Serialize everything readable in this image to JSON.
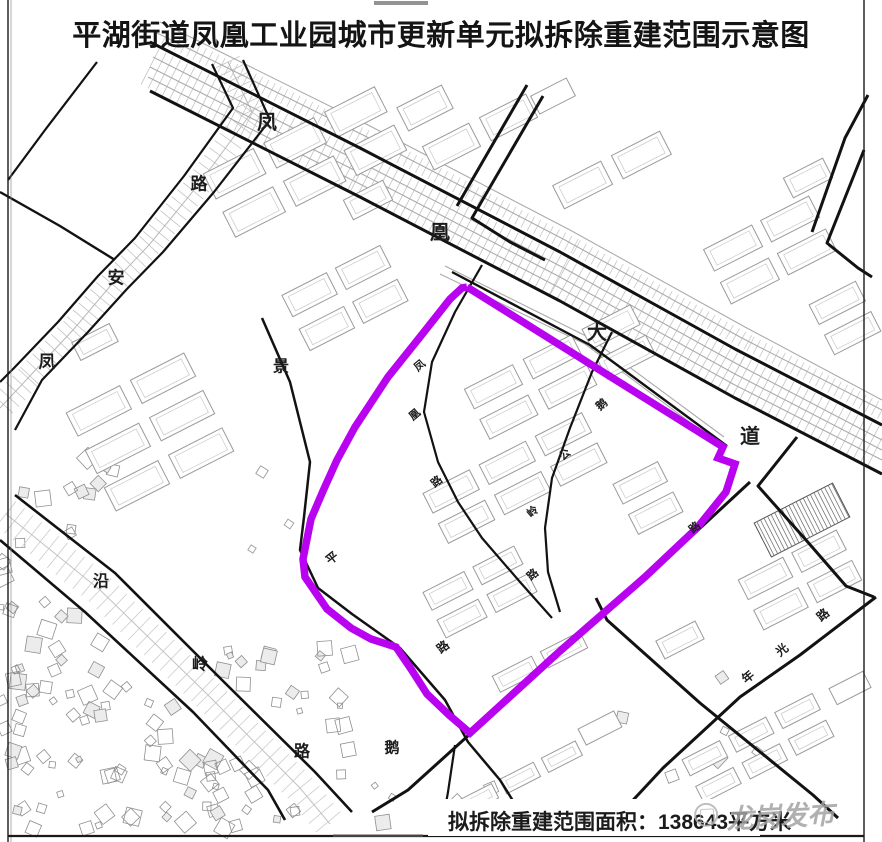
{
  "title": "平湖街道凤凰工业园城市更新单元拟拆除重建范围示意图",
  "caption": {
    "text": "拟拆除重建范围面积：138643平方米",
    "label": "拟拆除重建范围面积",
    "value": "138643",
    "unit": "平方米"
  },
  "watermark": {
    "text": "龙岗发布",
    "logo": "circle-emblem"
  },
  "map": {
    "colors": {
      "boundary": "#b802f0",
      "road": "#121212",
      "building": "#9a9a9a",
      "hatch": "#bdbdbd",
      "frame": "#1a1a1a"
    },
    "boundary": {
      "width": 7.5,
      "points": [
        [
          467,
          287
        ],
        [
          723,
          447
        ],
        [
          718,
          458
        ],
        [
          735,
          464
        ],
        [
          726,
          492
        ],
        [
          697,
          528
        ],
        [
          645,
          577
        ],
        [
          560,
          651
        ],
        [
          470,
          733
        ],
        [
          449,
          715
        ],
        [
          427,
          694
        ],
        [
          411,
          669
        ],
        [
          396,
          647
        ],
        [
          371,
          639
        ],
        [
          351,
          628
        ],
        [
          327,
          609
        ],
        [
          305,
          577
        ],
        [
          303,
          559
        ],
        [
          311,
          519
        ],
        [
          323,
          491
        ],
        [
          337,
          460
        ],
        [
          355,
          427
        ],
        [
          388,
          377
        ],
        [
          420,
          337
        ],
        [
          450,
          299
        ],
        [
          462,
          288
        ],
        [
          467,
          287
        ]
      ]
    },
    "labels": [
      {
        "t": "凤",
        "x": 267,
        "y": 123,
        "s": 20
      },
      {
        "t": "凰",
        "x": 440,
        "y": 233,
        "s": 20
      },
      {
        "t": "大",
        "x": 597,
        "y": 333,
        "s": 20
      },
      {
        "t": "道",
        "x": 750,
        "y": 437,
        "s": 20
      },
      {
        "t": "路",
        "x": 199,
        "y": 184,
        "s": 17
      },
      {
        "t": "安",
        "x": 116,
        "y": 278,
        "s": 17
      },
      {
        "t": "凤",
        "x": 47,
        "y": 362,
        "s": 17
      },
      {
        "t": "景",
        "x": 281,
        "y": 367,
        "s": 16
      },
      {
        "t": "沿",
        "x": 101,
        "y": 582,
        "s": 16
      },
      {
        "t": "岭",
        "x": 200,
        "y": 665,
        "s": 16
      },
      {
        "t": "路",
        "x": 302,
        "y": 752,
        "s": 16
      },
      {
        "t": "鹅",
        "x": 392,
        "y": 748,
        "s": 15
      },
      {
        "t": "平",
        "x": 332,
        "y": 558,
        "s": 12,
        "r": -38
      },
      {
        "t": "路",
        "x": 443,
        "y": 647,
        "s": 12,
        "r": -38
      },
      {
        "t": "凤",
        "x": 420,
        "y": 366,
        "s": 11,
        "r": -40
      },
      {
        "t": "凰",
        "x": 415,
        "y": 415,
        "s": 11,
        "r": -40
      },
      {
        "t": "路",
        "x": 437,
        "y": 482,
        "s": 11,
        "r": -40
      },
      {
        "t": "鹅",
        "x": 602,
        "y": 405,
        "s": 11,
        "r": -40
      },
      {
        "t": "公",
        "x": 565,
        "y": 455,
        "s": 11,
        "r": -40
      },
      {
        "t": "岭",
        "x": 533,
        "y": 512,
        "s": 11,
        "r": -40
      },
      {
        "t": "路",
        "x": 533,
        "y": 575,
        "s": 11,
        "r": -40
      },
      {
        "t": "路",
        "x": 695,
        "y": 528,
        "s": 11,
        "r": -40
      },
      {
        "t": "路",
        "x": 823,
        "y": 615,
        "s": 12,
        "r": -40
      },
      {
        "t": "光",
        "x": 782,
        "y": 650,
        "s": 12,
        "r": -40
      },
      {
        "t": "年",
        "x": 748,
        "y": 677,
        "s": 12,
        "r": -40
      }
    ],
    "corridors": {
      "avenue": {
        "center": [
          [
            150,
            67
          ],
          [
            360,
            173
          ],
          [
            560,
            277
          ],
          [
            735,
            374
          ],
          [
            882,
            450
          ]
        ],
        "half": 20,
        "tickStep": 8
      },
      "fengan": {
        "center": [
          [
            228,
            62
          ],
          [
            252,
            112
          ],
          [
            199,
            184
          ],
          [
            149,
            245
          ],
          [
            112,
            284
          ],
          [
            73,
            330
          ],
          [
            28,
            378
          ],
          [
            0,
            408
          ]
        ],
        "half": 13,
        "tickStep": 9
      },
      "yanling": {
        "center": [
          [
            6,
            514
          ],
          [
            100,
            590
          ],
          [
            208,
            695
          ],
          [
            300,
            788
          ],
          [
            330,
            824
          ]
        ],
        "half": 16,
        "tickStep": 11
      }
    },
    "gray_lines": [
      [
        [
          153,
          57
        ],
        [
          362,
          163
        ],
        [
          562,
          267
        ],
        [
          737,
          364
        ],
        [
          882,
          440
        ]
      ],
      [
        [
          150,
          67
        ],
        [
          360,
          173
        ],
        [
          560,
          277
        ],
        [
          735,
          374
        ],
        [
          882,
          450
        ]
      ],
      [
        [
          148,
          77
        ],
        [
          358,
          183
        ],
        [
          558,
          287
        ],
        [
          733,
          384
        ],
        [
          882,
          460
        ]
      ],
      [
        [
          160,
          22
        ],
        [
          370,
          126
        ],
        [
          570,
          230
        ],
        [
          745,
          327
        ],
        [
          882,
          400
        ]
      ],
      [
        [
          155,
          32
        ],
        [
          365,
          136
        ],
        [
          565,
          240
        ],
        [
          740,
          337
        ],
        [
          882,
          410
        ]
      ],
      [
        [
          445,
          266
        ],
        [
          590,
          338
        ],
        [
          724,
          437
        ]
      ],
      [
        [
          440,
          274
        ],
        [
          585,
          344
        ],
        [
          719,
          444
        ]
      ]
    ],
    "roads": [
      {
        "n": "road-crossing-nw",
        "w": 2.4,
        "p": [
          [
            0,
            192
          ],
          [
            60,
            226
          ],
          [
            115,
            260
          ]
        ]
      },
      {
        "n": "road-nw-corner",
        "w": 2.2,
        "p": [
          [
            97,
            62
          ],
          [
            45,
            130
          ],
          [
            8,
            180
          ]
        ]
      },
      {
        "n": "avenue-north-edge",
        "w": 3,
        "p": [
          [
            150,
            42
          ],
          [
            360,
            148
          ],
          [
            560,
            252
          ],
          [
            735,
            349
          ],
          [
            882,
            425
          ]
        ]
      },
      {
        "n": "avenue-south-edge",
        "w": 3,
        "p": [
          [
            150,
            91
          ],
          [
            360,
            197
          ],
          [
            560,
            301
          ],
          [
            735,
            398
          ],
          [
            882,
            474
          ]
        ]
      },
      {
        "n": "avenue-south-service",
        "w": 2.4,
        "p": [
          [
            452,
            272
          ],
          [
            590,
            345
          ],
          [
            727,
            446
          ]
        ]
      },
      {
        "n": "branch-north-1",
        "w": 3,
        "p": [
          [
            527,
            85
          ],
          [
            457,
            206
          ]
        ]
      },
      {
        "n": "branch-north-2",
        "w": 3,
        "p": [
          [
            543,
            96
          ],
          [
            472,
            218
          ],
          [
            510,
            242
          ],
          [
            545,
            260
          ]
        ]
      },
      {
        "n": "branch-ne-1",
        "w": 3,
        "p": [
          [
            868,
            95
          ],
          [
            845,
            138
          ],
          [
            812,
            232
          ]
        ]
      },
      {
        "n": "branch-ne-2",
        "w": 3,
        "p": [
          [
            864,
            150
          ],
          [
            827,
            243
          ],
          [
            858,
            268
          ],
          [
            872,
            277
          ]
        ]
      },
      {
        "n": "fengan-east-edge",
        "w": 2.2,
        "p": [
          [
            243,
            60
          ],
          [
            270,
            120
          ],
          [
            214,
            192
          ],
          [
            163,
            252
          ],
          [
            126,
            290
          ],
          [
            88,
            332
          ],
          [
            42,
            380
          ],
          [
            15,
            430
          ]
        ]
      },
      {
        "n": "fengan-west-edge",
        "w": 2.2,
        "p": [
          [
            212,
            64
          ],
          [
            233,
            108
          ],
          [
            184,
            176
          ],
          [
            135,
            238
          ],
          [
            98,
            276
          ],
          [
            58,
            322
          ],
          [
            14,
            368
          ],
          [
            0,
            382
          ]
        ]
      },
      {
        "n": "pond-east-road",
        "w": 2.5,
        "p": [
          [
            262,
            318
          ],
          [
            290,
            382
          ],
          [
            310,
            462
          ],
          [
            304,
            517
          ],
          [
            300,
            550
          ],
          [
            318,
            588
          ],
          [
            352,
            614
          ],
          [
            400,
            648
          ],
          [
            445,
            700
          ],
          [
            468,
            742
          ],
          [
            500,
            780
          ],
          [
            520,
            812
          ]
        ]
      },
      {
        "n": "park-road-west",
        "w": 2.2,
        "p": [
          [
            482,
            265
          ],
          [
            455,
            312
          ],
          [
            432,
            362
          ],
          [
            424,
            412
          ],
          [
            438,
            462
          ],
          [
            458,
            502
          ],
          [
            482,
            538
          ],
          [
            520,
            582
          ],
          [
            552,
            618
          ]
        ]
      },
      {
        "n": "park-road-east",
        "w": 2.2,
        "p": [
          [
            612,
            332
          ],
          [
            592,
            372
          ],
          [
            570,
            428
          ],
          [
            552,
            478
          ],
          [
            545,
            528
          ],
          [
            548,
            572
          ],
          [
            560,
            612
          ]
        ]
      },
      {
        "n": "road-southeast-of-boundary",
        "w": 3,
        "p": [
          [
            750,
            482
          ],
          [
            697,
            531
          ],
          [
            646,
            577
          ],
          [
            560,
            653
          ],
          [
            470,
            734
          ],
          [
            408,
            790
          ],
          [
            372,
            812
          ]
        ]
      },
      {
        "n": "road-to-br-corner",
        "w": 3,
        "p": [
          [
            596,
            598
          ],
          [
            607,
            620
          ],
          [
            700,
            703
          ],
          [
            813,
            795
          ],
          [
            838,
            818
          ]
        ]
      },
      {
        "n": "road-from-right-edge",
        "w": 3,
        "p": [
          [
            876,
            597
          ],
          [
            800,
            655
          ],
          [
            740,
            697
          ],
          [
            663,
            768
          ],
          [
            622,
            812
          ]
        ]
      },
      {
        "n": "east-block-road",
        "w": 3,
        "p": [
          [
            797,
            437
          ],
          [
            758,
            486
          ],
          [
            806,
            540
          ],
          [
            846,
            586
          ],
          [
            874,
            597
          ]
        ]
      },
      {
        "n": "yanling-ne-edge",
        "w": 2.6,
        "p": [
          [
            15,
            495
          ],
          [
            115,
            573
          ],
          [
            222,
            680
          ],
          [
            315,
            772
          ],
          [
            352,
            812
          ]
        ]
      },
      {
        "n": "yanling-sw-edge",
        "w": 2.6,
        "p": [
          [
            0,
            540
          ],
          [
            85,
            612
          ],
          [
            193,
            712
          ],
          [
            268,
            790
          ],
          [
            285,
            820
          ]
        ]
      },
      {
        "n": "road-below-v",
        "w": 2.2,
        "p": [
          [
            455,
            745
          ],
          [
            448,
            792
          ],
          [
            443,
            820
          ]
        ]
      }
    ],
    "blocks": [
      {
        "cx": 305,
        "cy": 162,
        "rot": -27,
        "rows": 2,
        "cols": 3,
        "w": 56,
        "h": 28,
        "gx": 12,
        "gy": 15
      },
      {
        "cx": 480,
        "cy": 132,
        "rot": -27,
        "rows": 1,
        "cols": 2,
        "w": 52,
        "h": 26,
        "gx": 12,
        "gy": 12
      },
      {
        "cx": 612,
        "cy": 170,
        "rot": -27,
        "rows": 1,
        "cols": 2,
        "w": 54,
        "h": 26,
        "gx": 12,
        "gy": 12
      },
      {
        "cx": 770,
        "cy": 250,
        "rot": -27,
        "rows": 2,
        "cols": 2,
        "w": 54,
        "h": 24,
        "gx": 10,
        "gy": 13
      },
      {
        "cx": 150,
        "cy": 432,
        "rot": -27,
        "rows": 3,
        "cols": 2,
        "w": 60,
        "h": 26,
        "gx": 12,
        "gy": 16
      },
      {
        "cx": 345,
        "cy": 298,
        "rot": -27,
        "rows": 2,
        "cols": 2,
        "w": 50,
        "h": 24,
        "gx": 10,
        "gy": 14
      },
      {
        "cx": 560,
        "cy": 372,
        "rot": -27,
        "rows": 2,
        "cols": 3,
        "w": 54,
        "h": 22,
        "gx": 12,
        "gy": 12
      },
      {
        "cx": 515,
        "cy": 478,
        "rot": -27,
        "rows": 2,
        "cols": 3,
        "w": 52,
        "h": 22,
        "gx": 11,
        "gy": 12
      },
      {
        "cx": 648,
        "cy": 498,
        "rot": -27,
        "rows": 2,
        "cols": 1,
        "w": 50,
        "h": 22,
        "gx": 10,
        "gy": 12
      },
      {
        "cx": 480,
        "cy": 592,
        "rot": -27,
        "rows": 2,
        "cols": 2,
        "w": 46,
        "h": 20,
        "gx": 10,
        "gy": 11
      },
      {
        "cx": 540,
        "cy": 662,
        "rot": -27,
        "rows": 1,
        "cols": 2,
        "w": 44,
        "h": 18,
        "gx": 10,
        "gy": 10
      },
      {
        "cx": 800,
        "cy": 580,
        "rot": -27,
        "rows": 2,
        "cols": 2,
        "w": 50,
        "h": 22,
        "gx": 10,
        "gy": 12
      },
      {
        "cx": 758,
        "cy": 748,
        "rot": -27,
        "rows": 2,
        "cols": 3,
        "w": 42,
        "h": 18,
        "gx": 10,
        "gy": 12
      },
      {
        "cx": 520,
        "cy": 778,
        "rot": -27,
        "rows": 1,
        "cols": 3,
        "w": 38,
        "h": 16,
        "gx": 9,
        "gy": 9
      },
      {
        "cx": 845,
        "cy": 318,
        "rot": -27,
        "rows": 2,
        "cols": 1,
        "w": 52,
        "h": 22,
        "gx": 10,
        "gy": 12
      }
    ],
    "singles": [
      {
        "cx": 425,
        "cy": 108,
        "rot": -27,
        "w": 50,
        "h": 26
      },
      {
        "cx": 553,
        "cy": 96,
        "rot": -27,
        "w": 40,
        "h": 20
      },
      {
        "cx": 95,
        "cy": 342,
        "rot": -27,
        "w": 42,
        "h": 20
      },
      {
        "cx": 680,
        "cy": 640,
        "rot": -27,
        "w": 44,
        "h": 20
      },
      {
        "cx": 600,
        "cy": 728,
        "rot": -27,
        "w": 40,
        "h": 18
      },
      {
        "cx": 850,
        "cy": 688,
        "rot": -27,
        "w": 38,
        "h": 18
      },
      {
        "cx": 808,
        "cy": 178,
        "rot": -27,
        "w": 44,
        "h": 22
      },
      {
        "cx": 368,
        "cy": 200,
        "rot": -27,
        "w": 44,
        "h": 22
      }
    ],
    "hatch_block": {
      "cx": 802,
      "cy": 520,
      "w": 88,
      "h": 38,
      "rot": -27
    },
    "pond_marks": [
      [
        262,
        472,
        9
      ],
      [
        289,
        524,
        7
      ],
      [
        252,
        549,
        6
      ]
    ],
    "frame": {
      "left1": 8,
      "left2": 11,
      "right": 864,
      "bottom": 836
    }
  }
}
